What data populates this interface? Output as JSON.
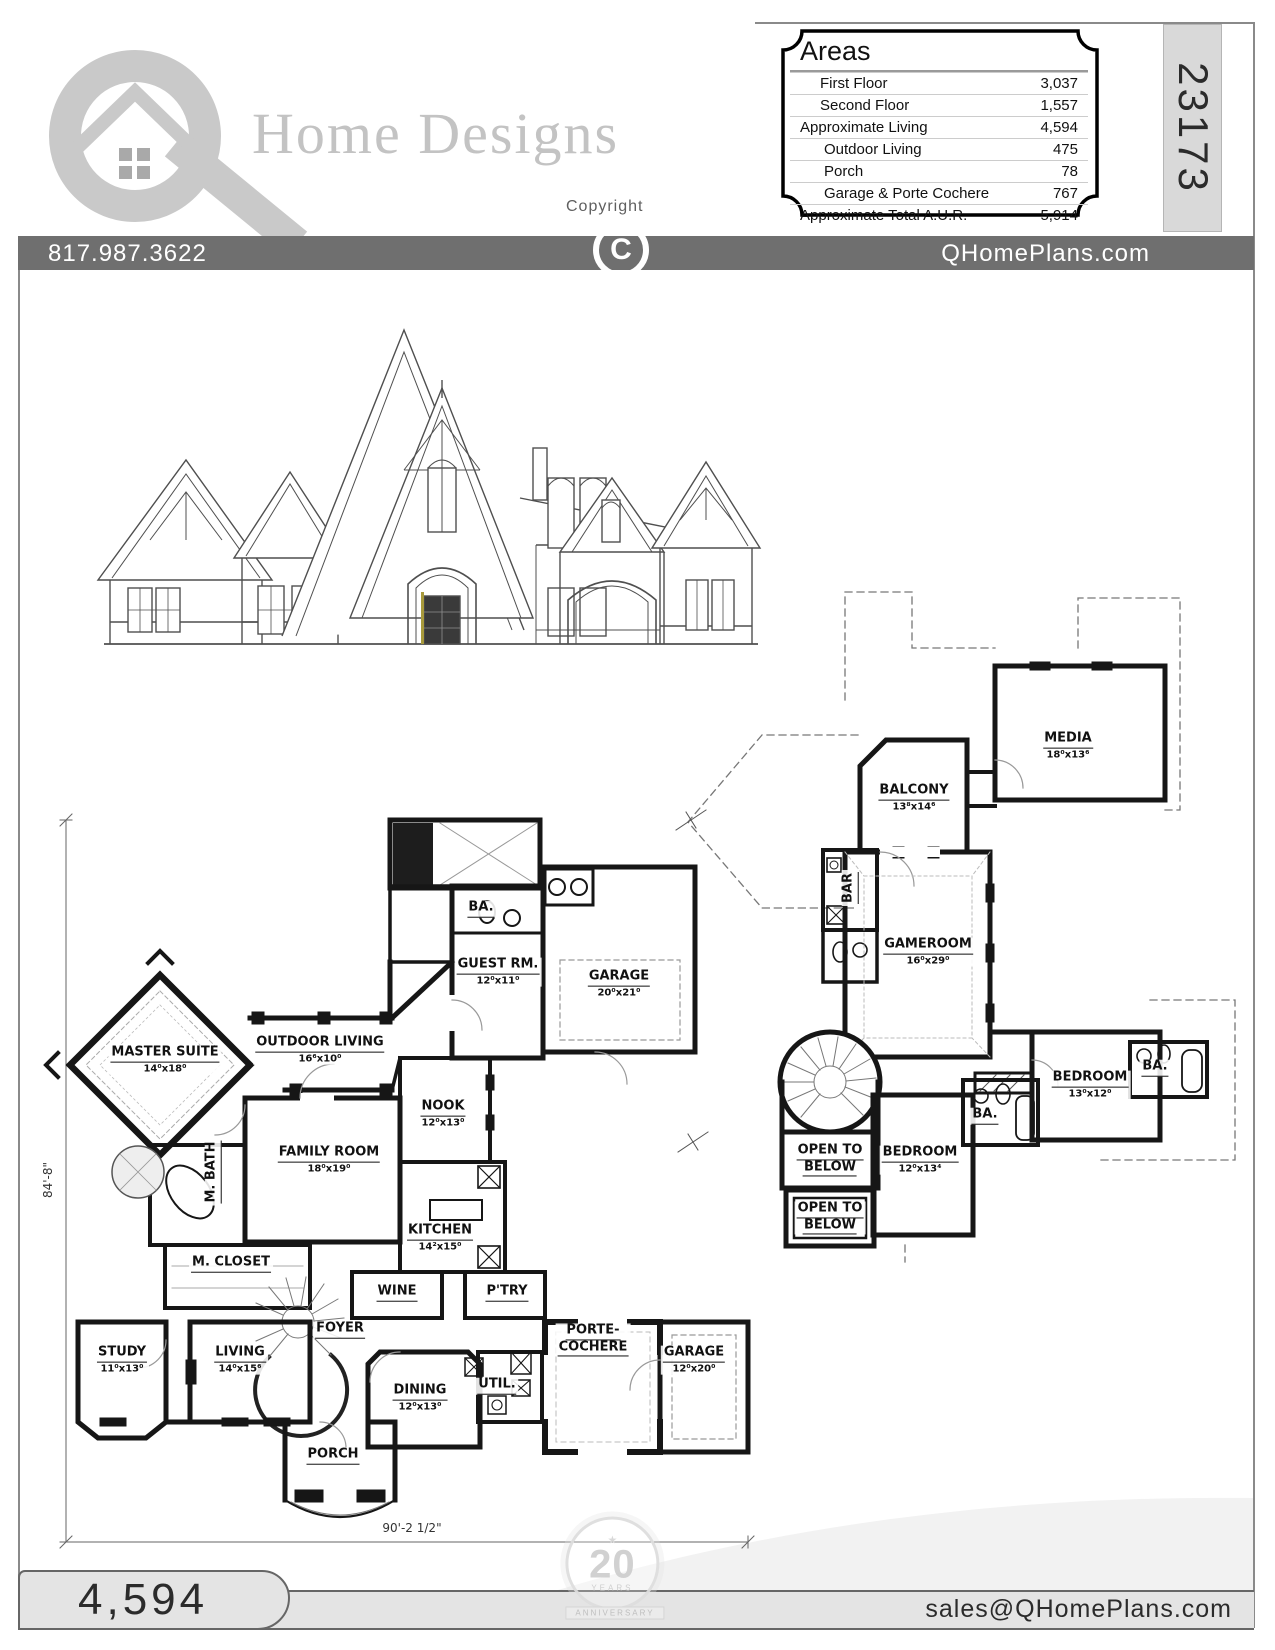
{
  "header": {
    "logo_text": "Home Designs",
    "copyright_label": "Copyright",
    "copyright_symbol": "C",
    "plan_number": "23173",
    "areas": {
      "title": "Areas",
      "rows": [
        {
          "label": "First Floor",
          "value": "3,037"
        },
        {
          "label": "Second Floor",
          "value": "1,557"
        },
        {
          "label": "Approximate Living",
          "value": "4,594"
        },
        {
          "label": "Outdoor Living",
          "value": "475"
        },
        {
          "label": "Porch",
          "value": "78"
        },
        {
          "label": "Garage & Porte Cochere",
          "value": "767"
        },
        {
          "label": "Approximate Total A.U.R.",
          "value": "5,914"
        }
      ]
    }
  },
  "banner": {
    "phone": "817.987.3622",
    "website": "QHomePlans.com"
  },
  "first_floor": {
    "rooms": [
      {
        "name": "MASTER SUITE",
        "dims": "14⁰x18⁰"
      },
      {
        "name": "OUTDOOR LIVING",
        "dims": "16⁶x10⁰"
      },
      {
        "name": "BA."
      },
      {
        "name": "GUEST RM.",
        "dims": "12⁰x11⁰"
      },
      {
        "name": "GARAGE",
        "dims": "20⁰x21⁰"
      },
      {
        "name": "NOOK",
        "dims": "12⁰x13⁰"
      },
      {
        "name": "FAMILY ROOM",
        "dims": "18⁰x19⁰"
      },
      {
        "name": "M. BATH"
      },
      {
        "name": "M. CLOSET"
      },
      {
        "name": "KITCHEN",
        "dims": "14²x15⁰"
      },
      {
        "name": "WINE"
      },
      {
        "name": "P'TRY"
      },
      {
        "name": "FOYER"
      },
      {
        "name": "STUDY",
        "dims": "11⁰x13⁰"
      },
      {
        "name": "LIVING",
        "dims": "14⁰x15⁶"
      },
      {
        "name": "DINING",
        "dims": "12⁰x13⁰"
      },
      {
        "name": "UTIL."
      },
      {
        "name": "PORTE-",
        "name2": "COCHERE"
      },
      {
        "name": "GARAGE",
        "dims": "12⁰x20⁰"
      },
      {
        "name": "PORCH"
      }
    ],
    "dim_width": "90'-2 1/2\"",
    "dim_height": "84'-8\""
  },
  "second_floor": {
    "rooms": [
      {
        "name": "MEDIA",
        "dims": "18⁰x13⁶"
      },
      {
        "name": "BALCONY",
        "dims": "13⁸x14⁶"
      },
      {
        "name": "BAR"
      },
      {
        "name": "GAMEROOM",
        "dims": "16⁰x29⁰"
      },
      {
        "name": "BEDROOM",
        "dims": "13⁰x12⁰"
      },
      {
        "name": "BA."
      },
      {
        "name": "BA."
      },
      {
        "name": "BEDROOM",
        "dims": "12⁰x13⁴"
      },
      {
        "name": "OPEN TO",
        "name2": "BELOW"
      },
      {
        "name": "OPEN TO",
        "name2": "BELOW"
      }
    ]
  },
  "footer": {
    "living_area": "4,594",
    "email": "sales@QHomePlans.com"
  },
  "watermark": {
    "number": "20",
    "caption": "YEARS",
    "ribbon": "ANNIVERSARY"
  }
}
